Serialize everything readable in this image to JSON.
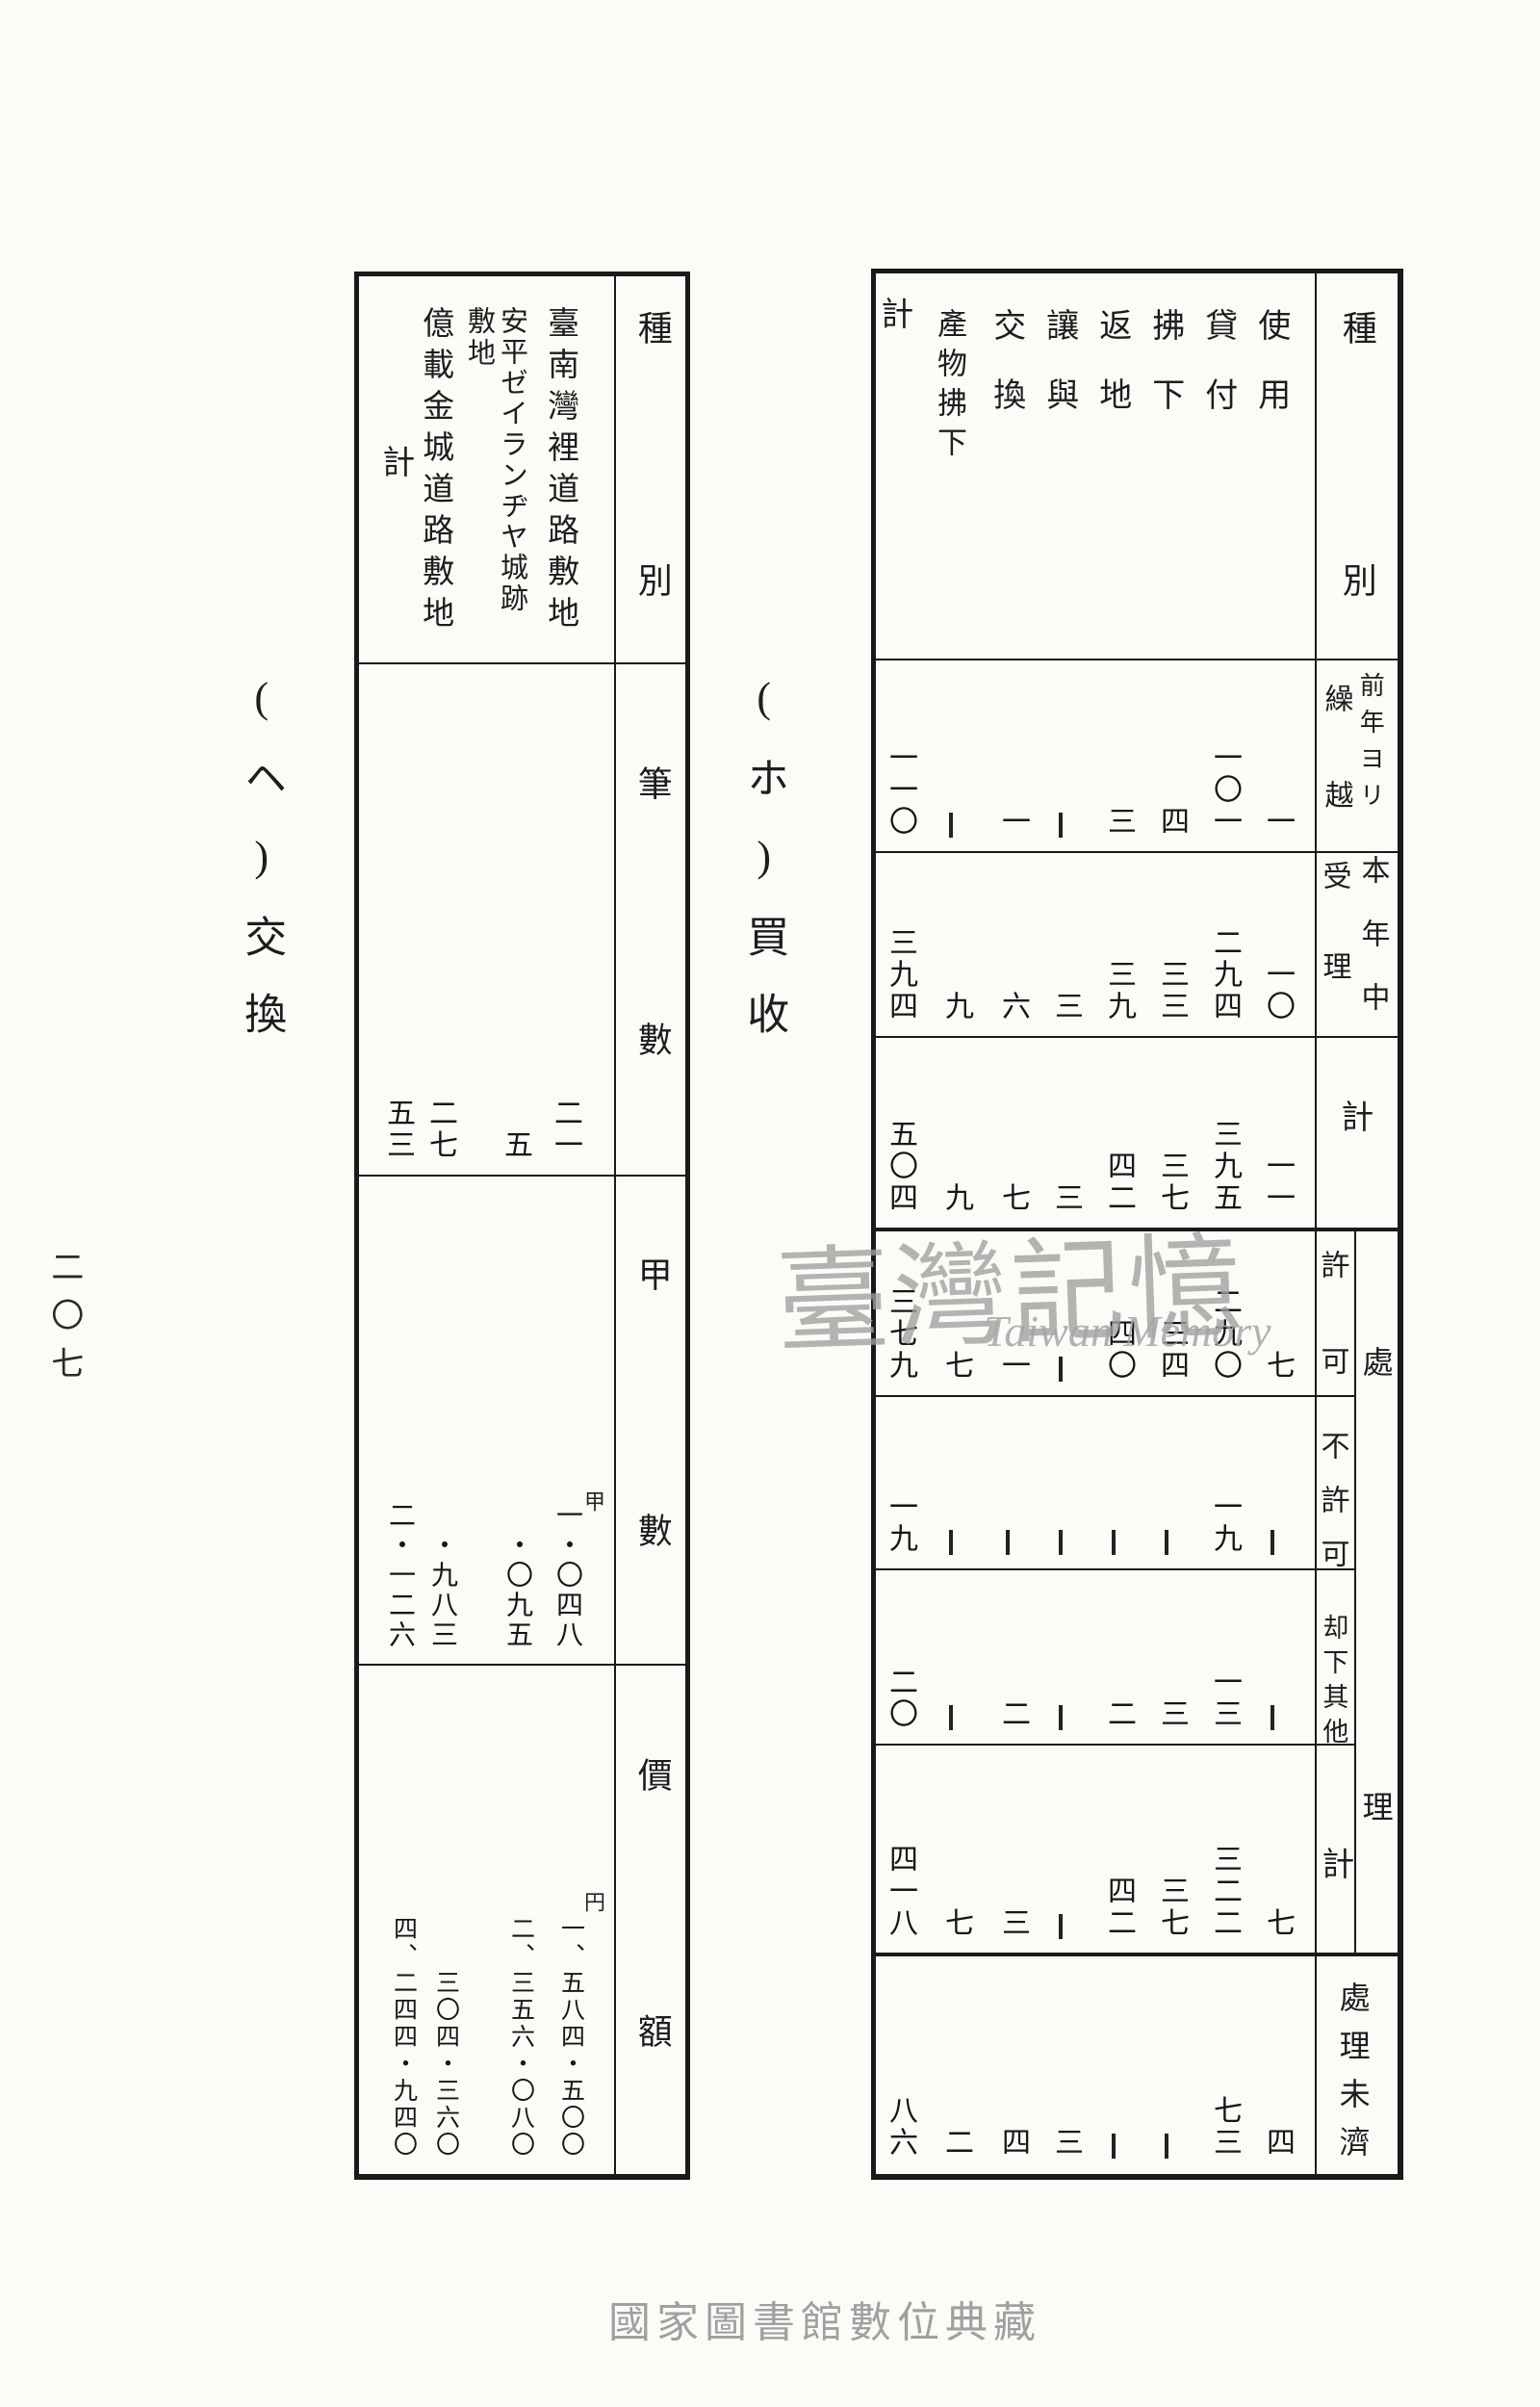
{
  "page": {
    "page_number": "二〇七",
    "footer": "國家圖書館數位典藏",
    "watermark_cjk": "臺灣記憶",
    "watermark_latin": "Taiwan Memory",
    "ink_color": "#1a1a1a",
    "paper_color": "#fcfbf8",
    "watermark_color": "#9f9f9f"
  },
  "right_table": {
    "title": "(ホ)買收",
    "header": {
      "shubetsu": "種別",
      "row1_main": "前年ヨリ",
      "row1_sub": "繰越",
      "row2_main": "本年中",
      "row2_sub": "受理",
      "row3": "計",
      "group": "處理",
      "row4": "許可",
      "row5": "不許可",
      "row6": "却下其他",
      "row7": "計",
      "row8": "處理未濟"
    },
    "columns": [
      "使用",
      "貸付",
      "拂下",
      "返地",
      "讓與",
      "交換",
      "產物拂下",
      "計"
    ],
    "rows": [
      {
        "name": "前年ヨリ繰越",
        "values": [
          "一",
          "一〇一",
          "四",
          "三",
          "—",
          "一",
          "—",
          "一一〇"
        ]
      },
      {
        "name": "本年中受理",
        "values": [
          "一〇",
          "二九四",
          "三三",
          "三九",
          "三",
          "六",
          "九",
          "三九四"
        ]
      },
      {
        "name": "計",
        "values": [
          "一一",
          "三九五",
          "三七",
          "四二",
          "三",
          "七",
          "九",
          "五〇四"
        ]
      },
      {
        "name": "許可",
        "values": [
          "七",
          "二九〇",
          "三四",
          "四〇",
          "—",
          "一",
          "七",
          "三七九"
        ]
      },
      {
        "name": "不許可",
        "values": [
          "—",
          "一九",
          "—",
          "—",
          "—",
          "—",
          "—",
          "一九"
        ]
      },
      {
        "name": "却下其他",
        "values": [
          "—",
          "一三",
          "三",
          "二",
          "—",
          "二",
          "—",
          "二〇"
        ]
      },
      {
        "name": "處理計",
        "values": [
          "七",
          "三二二",
          "三七",
          "四二",
          "—",
          "三",
          "七",
          "四一八"
        ]
      },
      {
        "name": "處理未濟",
        "values": [
          "四",
          "七三",
          "—",
          "—",
          "三",
          "四",
          "二",
          "八六"
        ]
      }
    ]
  },
  "left_table": {
    "title": "(ヘ)交換",
    "header": {
      "shubetsu": "種別",
      "row1": "筆數",
      "row2": "甲數",
      "row3": "價額"
    },
    "columns": [
      {
        "label": "臺南灣裡道路敷地"
      },
      {
        "label": "安平ゼイランヂヤ城跡",
        "label2": "敷地"
      },
      {
        "label": "億載金城道路敷地"
      },
      {
        "label": "計"
      }
    ],
    "rows": [
      {
        "name": "筆數",
        "unit": "",
        "values": [
          "二一",
          "五",
          "二七",
          "五三"
        ]
      },
      {
        "name": "甲數",
        "unit": "甲",
        "values": [
          "一・〇四八",
          "・〇九五",
          "・九八三",
          "二・一二六"
        ]
      },
      {
        "name": "價額",
        "unit": "円",
        "values": [
          "一、五八四・五〇〇",
          "二、三五六・〇八〇",
          "三〇四・三六〇",
          "四、二四四・九四〇"
        ]
      }
    ]
  }
}
